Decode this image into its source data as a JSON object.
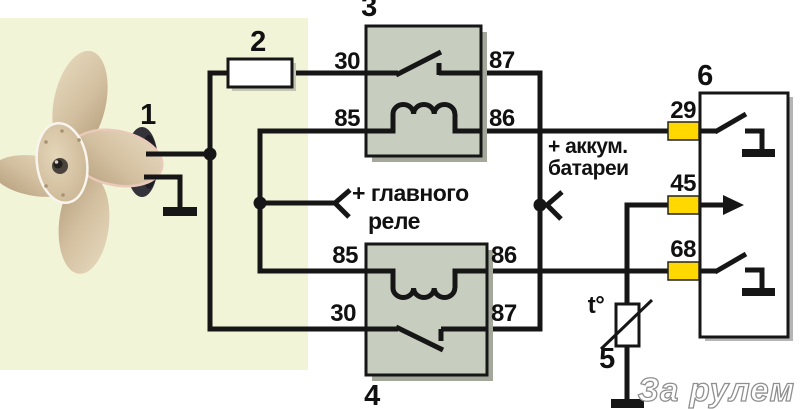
{
  "colors": {
    "panel": "#f2f4d8",
    "relay_fill": "#c7cdbf",
    "wire": "#161616",
    "pin_highlight": "#ffd800",
    "watermark_outline": "#8f8f8f"
  },
  "components": {
    "fan": {
      "label": "1"
    },
    "fuse": {
      "label": "2"
    },
    "relay_top": {
      "label": "3",
      "pins": {
        "left_top": "30",
        "left_bottom": "85",
        "right_top": "87",
        "right_bottom": "86"
      }
    },
    "relay_bottom": {
      "label": "4",
      "pins": {
        "left_top": "85",
        "left_bottom": "30",
        "right_top": "86",
        "right_bottom": "87"
      }
    },
    "sensor": {
      "label": "5",
      "symbol": "t°"
    },
    "connector": {
      "label": "6",
      "pins": {
        "top": "29",
        "middle": "45",
        "bottom": "68"
      }
    }
  },
  "annotations": {
    "main_relay_line1": "+ главного",
    "main_relay_line2": "реле",
    "battery_line1": "+ аккум.",
    "battery_line2": "батареи"
  },
  "watermark": "За рулем"
}
